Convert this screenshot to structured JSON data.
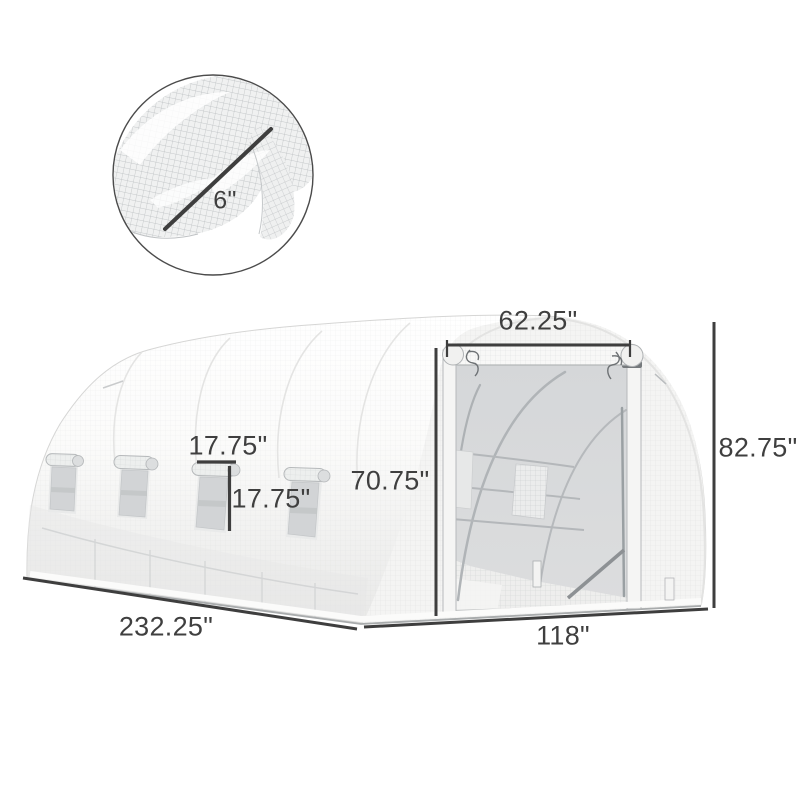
{
  "diagram": {
    "subject": "white walk-in tunnel greenhouse with roll-up door, side roll-up windows and mesh cover close-up inset",
    "dimensions": {
      "mesh_detail": "6\"",
      "door_width": "62.25\"",
      "overall_height": "82.75\"",
      "door_height": "70.75\"",
      "window_width": "17.75\"",
      "window_height": "17.75\"",
      "overall_length": "232.25\"",
      "overall_width": "118\""
    },
    "colors": {
      "dimension_lines": "#3e3e3e",
      "fabric": "#f4f4f3",
      "door_mesh": "#d6d8da",
      "background": "#ffffff"
    }
  }
}
